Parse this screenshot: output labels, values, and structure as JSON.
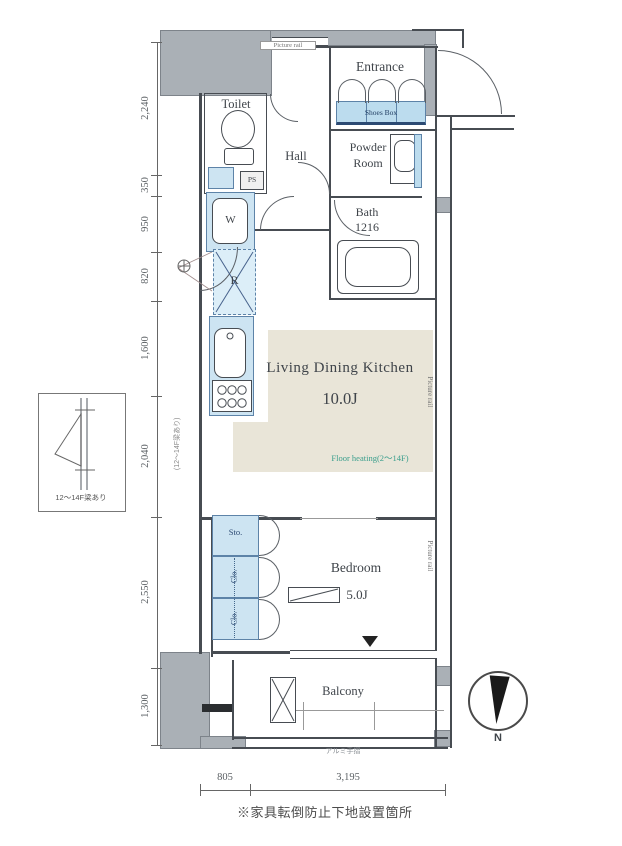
{
  "rooms": {
    "entrance": "Entrance",
    "toilet": "Toilet",
    "hall": "Hall",
    "powder_room_line1": "Powder",
    "powder_room_line2": "Room",
    "bath_line1": "Bath",
    "bath_line2": "1216",
    "ldk_label": "Living Dining Kitchen",
    "ldk_size": "10.0J",
    "bedroom_label": "Bedroom",
    "bedroom_size": "5.0J",
    "balcony": "Balcony"
  },
  "fixtures": {
    "shoes_box": "Shoes Box",
    "ps": "PS",
    "washer": "W",
    "fridge": "R",
    "storage": "Sto.",
    "closet1": "Clo.",
    "closet2": "Clo."
  },
  "annotations": {
    "picture_rail": "Picture rail",
    "floor_heating": "Floor heating(2〜14F)",
    "aluminum_rail": "アルミ手摺",
    "beam_note_wall": "(12〜14F梁あり)",
    "beam_note_caption": "12〜14F梁あり",
    "furniture_note": "※家具転倒防止下地設置箇所",
    "compass_n": "N"
  },
  "dimensions": {
    "left": [
      "2,240",
      "350",
      "950",
      "820",
      "1,600",
      "2,040",
      "2,550",
      "1,300"
    ],
    "bottom": [
      "805",
      "3,195"
    ]
  },
  "colors": {
    "wall_gray": "#aab0b6",
    "fixture_blue": "#cde4f2",
    "floor_beige": "#e9e5d8",
    "heating_green": "#3a9e8c",
    "line_dark": "#474c52"
  }
}
